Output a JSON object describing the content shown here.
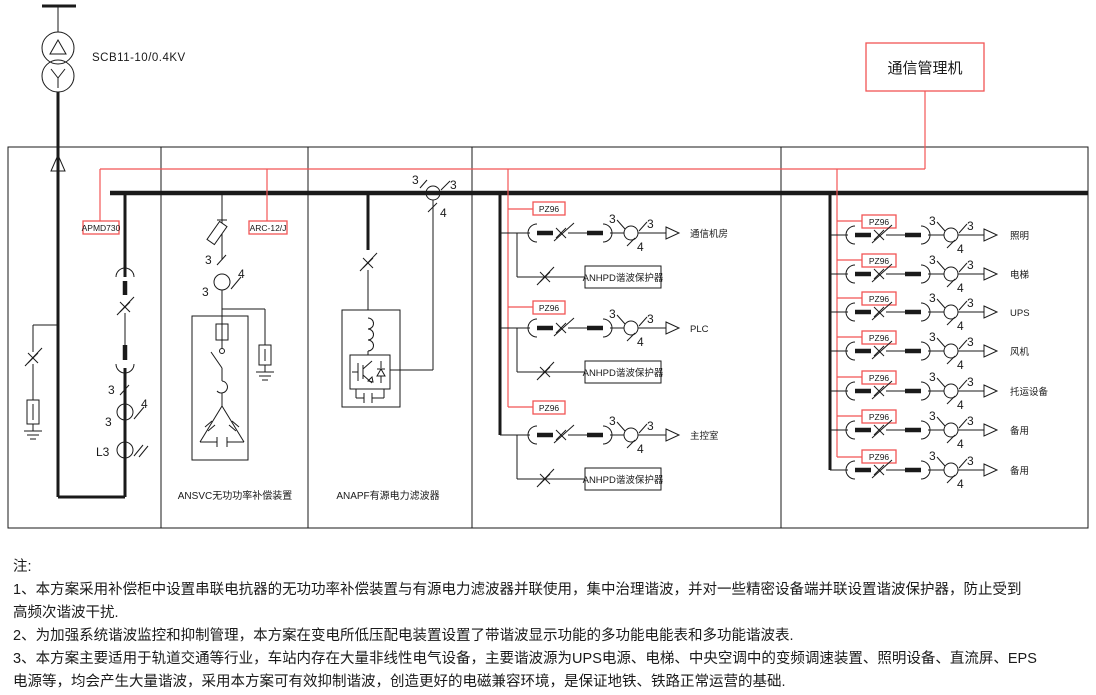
{
  "colors": {
    "ink": "#1a1a1a",
    "red": "#f25555",
    "background": "#ffffff"
  },
  "transformer": {
    "label": "SCB11-10/0.4KV"
  },
  "comm_manager": {
    "label": "通信管理机"
  },
  "devices": {
    "incoming_meter": "APMD730",
    "svc_controller": "ARC-12/J",
    "feeder_meter": "PZ96",
    "harmonic_protector": "ANHPD谐波保护器"
  },
  "ct": {
    "phase": "3",
    "wire": "4"
  },
  "incoming": {
    "l3_meter": "L3"
  },
  "panels": {
    "svc_label": "ANSVC无功功率补偿装置",
    "apf_label": "ANAPF有源电力滤波器"
  },
  "feeders_mid": [
    {
      "label": "通信机房"
    },
    {
      "label": "PLC"
    },
    {
      "label": "主控室"
    }
  ],
  "feeders_right": [
    {
      "label": "照明"
    },
    {
      "label": "电梯"
    },
    {
      "label": "UPS"
    },
    {
      "label": "风机"
    },
    {
      "label": "托运设备"
    },
    {
      "label": "备用"
    },
    {
      "label": "备用"
    }
  ],
  "notes": {
    "title": "注:",
    "line1": "1、本方案采用补偿柜中设置串联电抗器的无功功率补偿装置与有源电力滤波器并联使用，集中治理谐波，并对一些精密设备端并联设置谐波保护器，防止受到",
    "line2": "高频次谐波干扰.",
    "line3": "2、为加强系统谐波监控和抑制管理，本方案在变电所低压配电装置设置了带谐波显示功能的多功能电能表和多功能谐波表.",
    "line4": "3、本方案主要适用于轨道交通等行业，车站内存在大量非线性电气设备，主要谐波源为UPS电源、电梯、中央空调中的变频调速装置、照明设备、直流屏、EPS",
    "line5": "电源等，均会产生大量谐波，采用本方案可有效抑制谐波，创造更好的电磁兼容环境，是保证地铁、铁路正常运营的基础."
  }
}
